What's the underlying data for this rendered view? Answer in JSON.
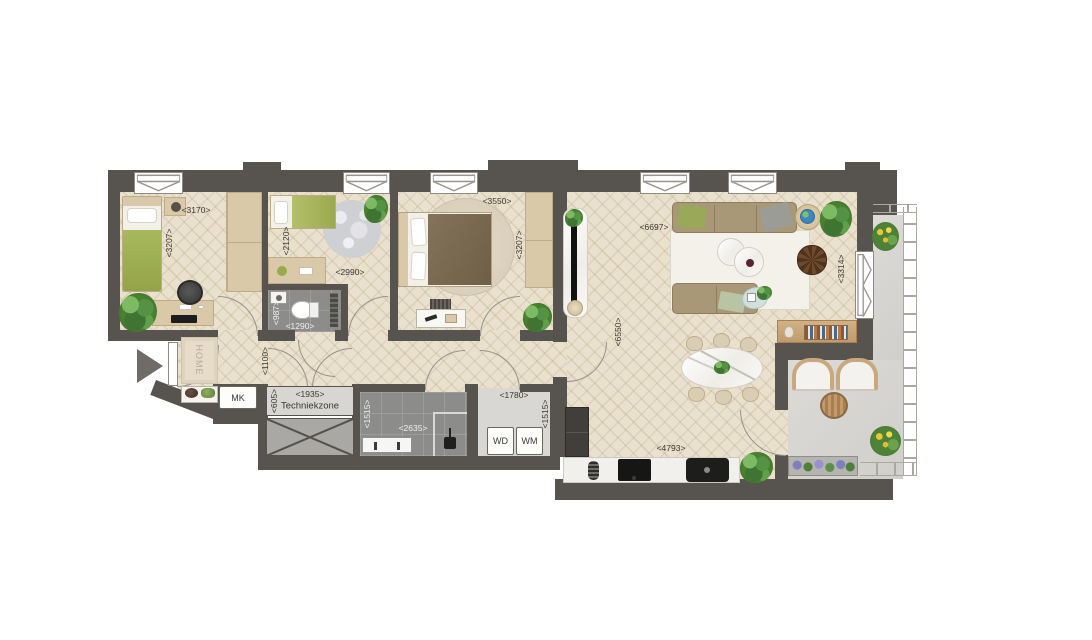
{
  "colors": {
    "wall": "#57534e",
    "floor_wood": "#e9e0cd",
    "tile_dark": "#8c8c8a",
    "floor_gray": "#d8d7d3",
    "balcony": "#d9d7d3",
    "furniture_beige": "#d9c9a9",
    "sofa_taupe": "#a89877",
    "bed_green": "#9faf55",
    "wood": "#c9a87c",
    "plant_green": "#48822f"
  },
  "entrance": {
    "doormat_label": "HOME"
  },
  "rooms": {
    "bedroom1": {
      "width": "<3170>",
      "depth": "<3207>"
    },
    "bedroom2": {
      "width": "<2990>",
      "depth": "<2120>"
    },
    "bedroom3": {
      "width": "<3550>",
      "depth": "<3207>"
    },
    "toilet": {
      "width": "<1290>",
      "depth": "<987>"
    },
    "hallway": {
      "width": "<1100>"
    },
    "meter_cupboard": {
      "label": "MK"
    },
    "techniekzone": {
      "label": "Techniekzone",
      "width": "<1935>",
      "depth": "<605>"
    },
    "bathroom": {
      "width": "<2635>",
      "depth": "<1515>"
    },
    "laundry": {
      "width": "<1780>",
      "depth": "<1515>",
      "dryer_label": "WD",
      "washer_label": "WM"
    },
    "living_room": {
      "width": "<6697>",
      "depth_right": "<3314>",
      "depth_left": "<6550>"
    },
    "kitchen": {
      "width": "<4793>"
    }
  }
}
